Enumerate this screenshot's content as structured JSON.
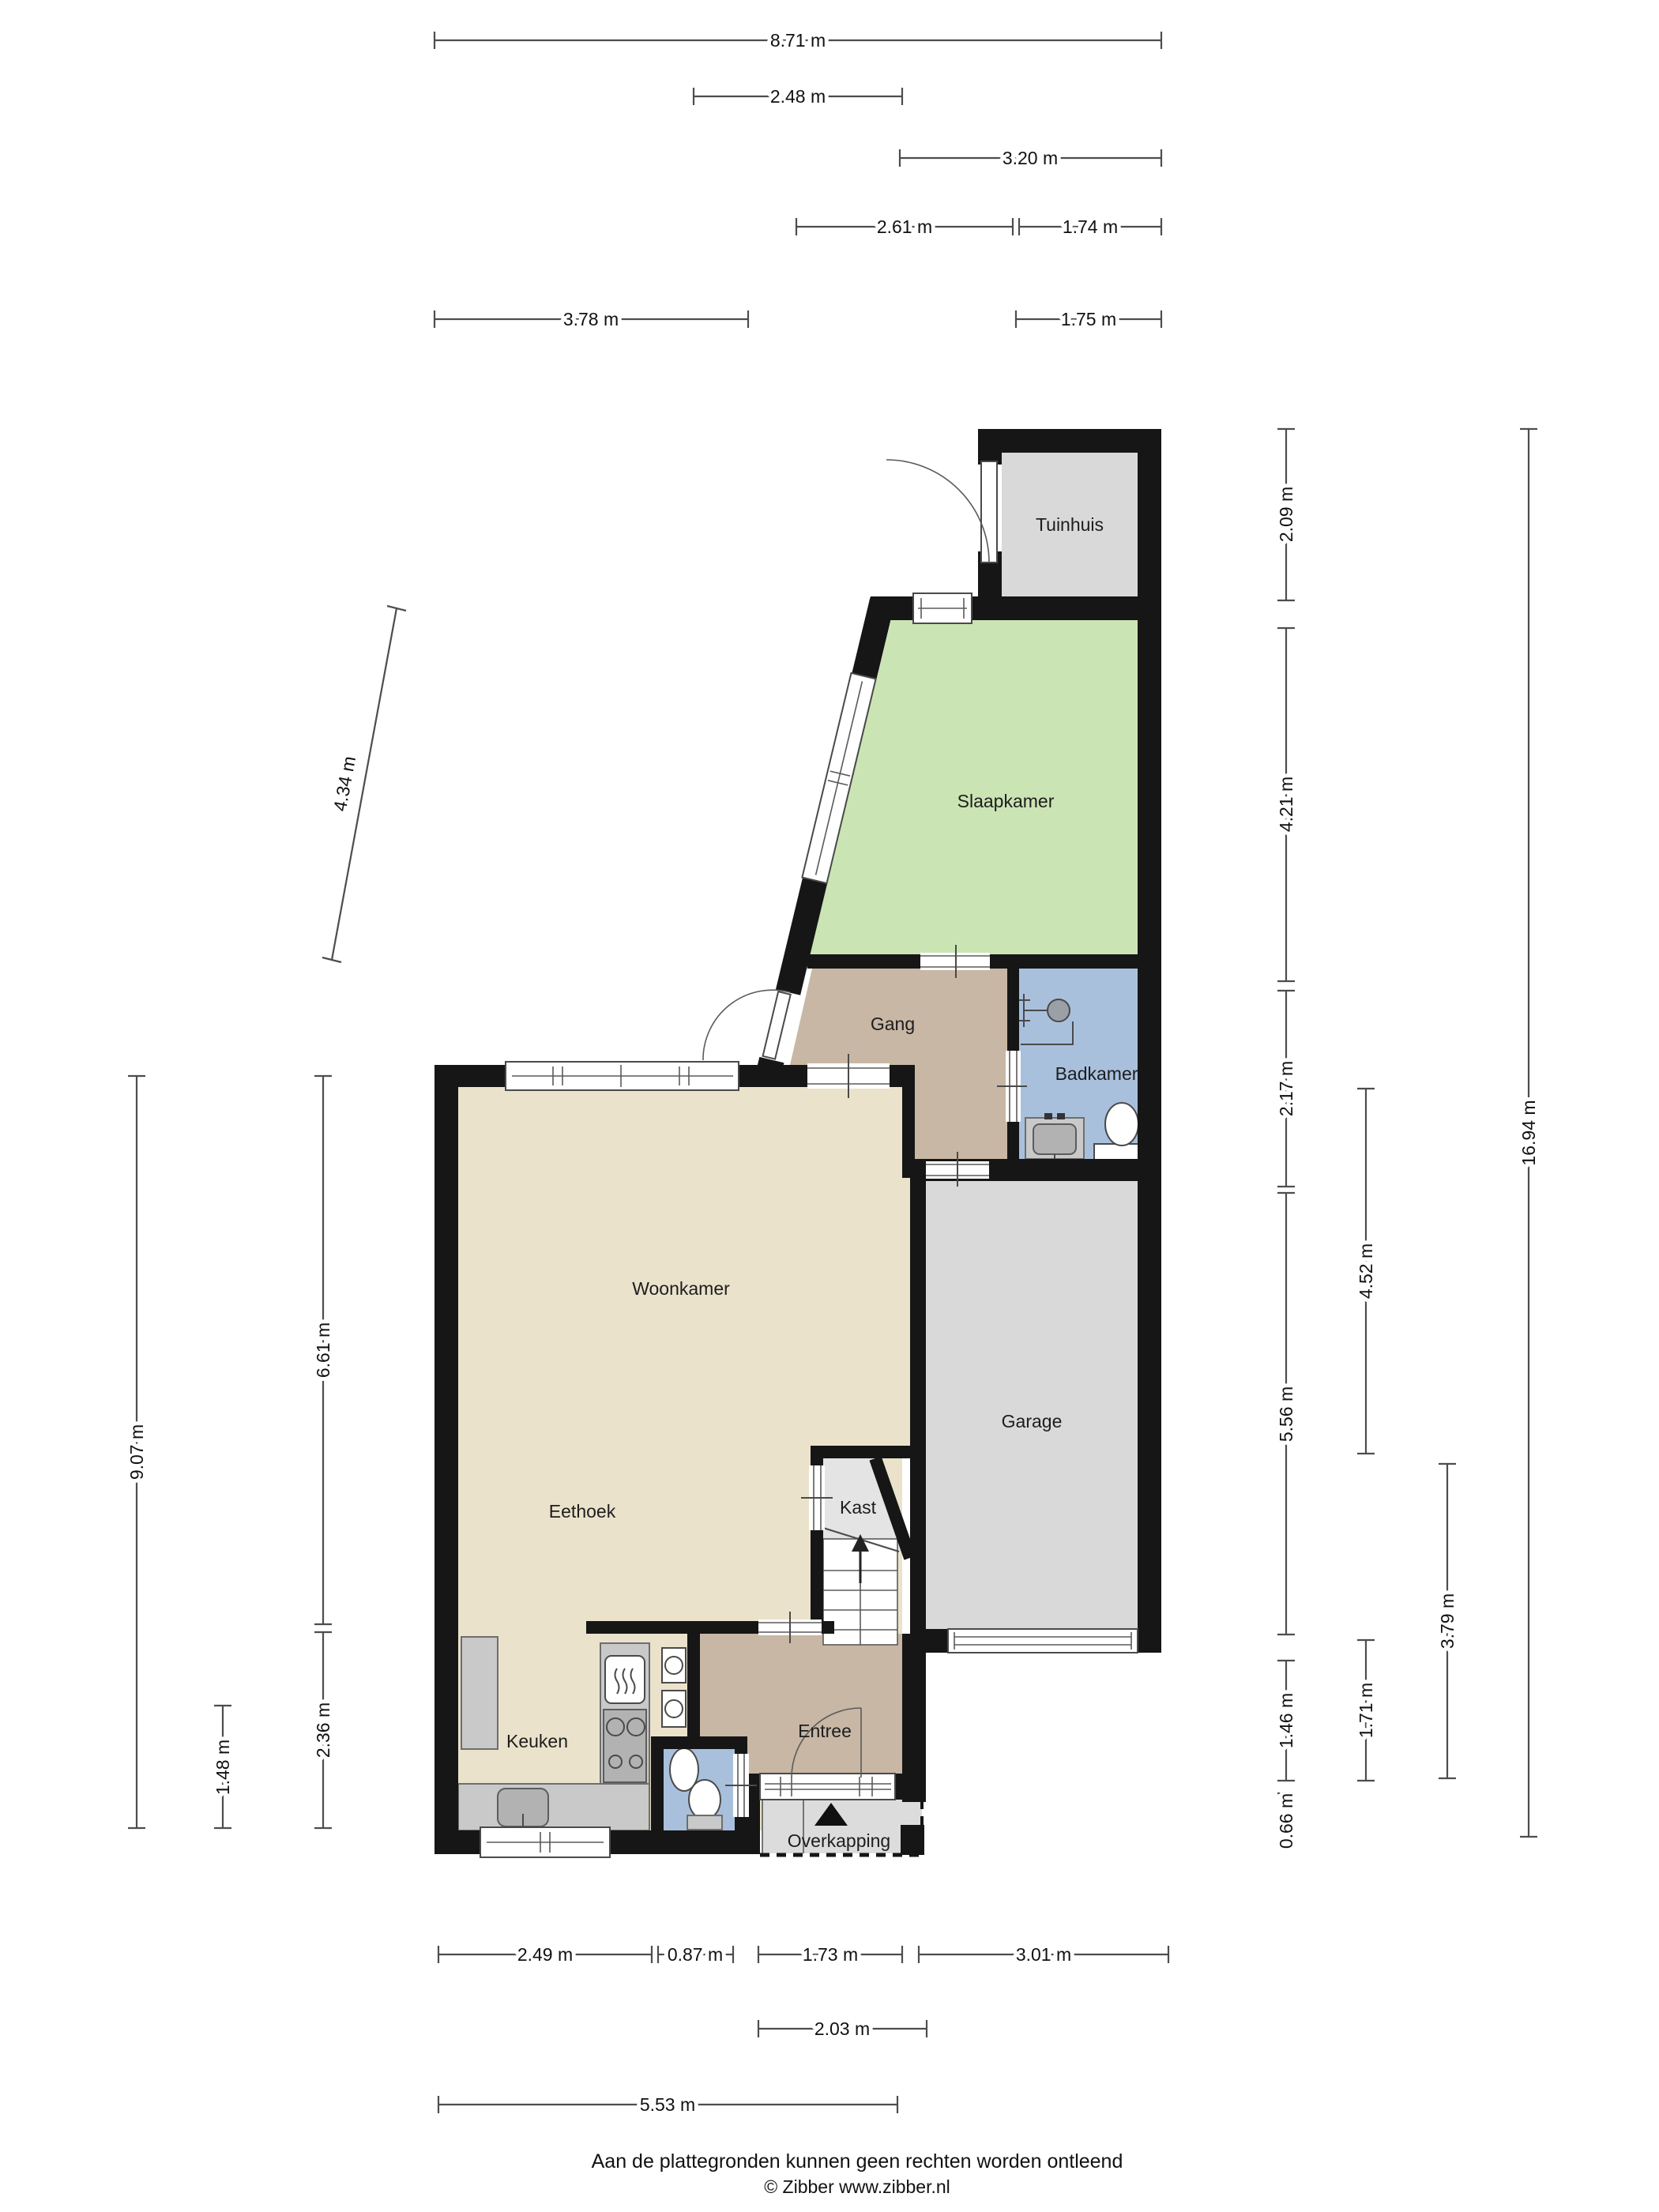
{
  "floorplan": {
    "rooms": [
      {
        "id": "tuinhuis",
        "label": "Tuinhuis"
      },
      {
        "id": "slaapkamer",
        "label": "Slaapkamer"
      },
      {
        "id": "gang",
        "label": "Gang"
      },
      {
        "id": "badkamer",
        "label": "Badkamer"
      },
      {
        "id": "woonkamer",
        "label": "Woonkamer"
      },
      {
        "id": "eethoek",
        "label": "Eethoek"
      },
      {
        "id": "keuken",
        "label": "Keuken"
      },
      {
        "id": "kast",
        "label": "Kast"
      },
      {
        "id": "entree",
        "label": "Entree"
      },
      {
        "id": "garage",
        "label": "Garage"
      },
      {
        "id": "overkapping",
        "label": "Overkapping"
      }
    ],
    "dimensions": {
      "top": [
        {
          "label": "8.71 m"
        },
        {
          "label": "2.48 m"
        },
        {
          "label": "3.20 m"
        },
        {
          "label": "2.61 m"
        },
        {
          "label": "1.74 m"
        },
        {
          "label": "3.78 m"
        },
        {
          "label": "1.75 m"
        }
      ],
      "right": [
        {
          "label": "2.09 m"
        },
        {
          "label": "4.21 m"
        },
        {
          "label": "2.17 m"
        },
        {
          "label": "5.56 m"
        },
        {
          "label": "1.46 m"
        },
        {
          "label": "0.66 m"
        },
        {
          "label": "4.52 m"
        },
        {
          "label": "1.71 m"
        },
        {
          "label": "3.79 m"
        },
        {
          "label": "16.94 m"
        }
      ],
      "left": [
        {
          "label": "9.07 m"
        },
        {
          "label": "6.61 m"
        },
        {
          "label": "2.36 m"
        },
        {
          "label": "1.48 m"
        },
        {
          "label": "4.34 m"
        }
      ],
      "bottom": [
        {
          "label": "2.49 m"
        },
        {
          "label": "0.87 m"
        },
        {
          "label": "1.73 m"
        },
        {
          "label": "3.01 m"
        },
        {
          "label": "2.03 m"
        },
        {
          "label": "5.53 m"
        }
      ]
    },
    "footer": {
      "disclaimer": "Aan de plattegronden kunnen geen rechten worden ontleend",
      "copyright": "© Zibber www.zibber.nl"
    },
    "colors": {
      "wall": "#161616",
      "living": "#eae2cb",
      "bedroom": "#cbe4b4",
      "hall": "#c8b7a5",
      "bath": "#a9c0dd",
      "garage": "#d9d9d9",
      "tuinhuis": "#d9d9d9",
      "storage": "#e4e4e4",
      "canopy": "#dcdcdc"
    }
  }
}
